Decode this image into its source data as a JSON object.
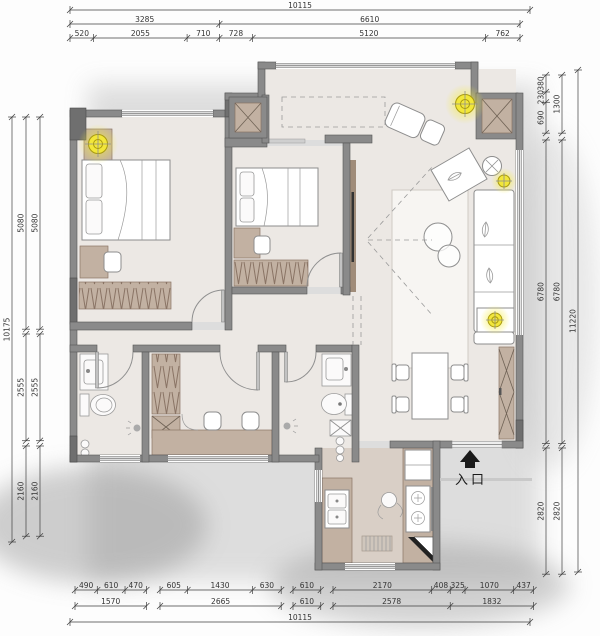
{
  "entry": {
    "label": "入口"
  },
  "dimensions": {
    "top": [
      [
        "10115"
      ],
      [
        "3285",
        "6610"
      ],
      [
        "520",
        "2055",
        "710",
        "728",
        "5120",
        "762"
      ]
    ],
    "bottom_row1": [
      [
        "490",
        "610",
        "470"
      ],
      [
        "605",
        "1430",
        "630"
      ],
      [
        "610"
      ],
      [
        "2170",
        "408",
        "325",
        "1070",
        "437"
      ]
    ],
    "bottom_row2": [
      [
        "1570"
      ],
      [
        "2665"
      ],
      [
        "610"
      ],
      [
        "2578",
        "1832"
      ]
    ],
    "bottom_overall": [
      "10115"
    ],
    "left_inner": [
      "5080",
      "2555",
      "2160"
    ],
    "left_mid": [
      "5080",
      "2555",
      "2160"
    ],
    "left_overall": [
      "10175"
    ],
    "right_inner_groups": [
      [
        "380",
        "230",
        "690"
      ],
      [
        "6780"
      ],
      [
        "2820"
      ]
    ],
    "right_mid_groups": [
      [
        "1300"
      ],
      [
        "6780"
      ],
      [
        "2820"
      ]
    ],
    "right_overall": [
      "11220"
    ]
  },
  "colors": {
    "wall": "#8a8a8a",
    "wall-dark": "#6f6f6f",
    "floor": "#ece8e4",
    "kitchen-floor": "#d9cfc6",
    "wood": "#c2b1a2",
    "wood-line": "#8a7465",
    "accent": "#f2e73a"
  }
}
